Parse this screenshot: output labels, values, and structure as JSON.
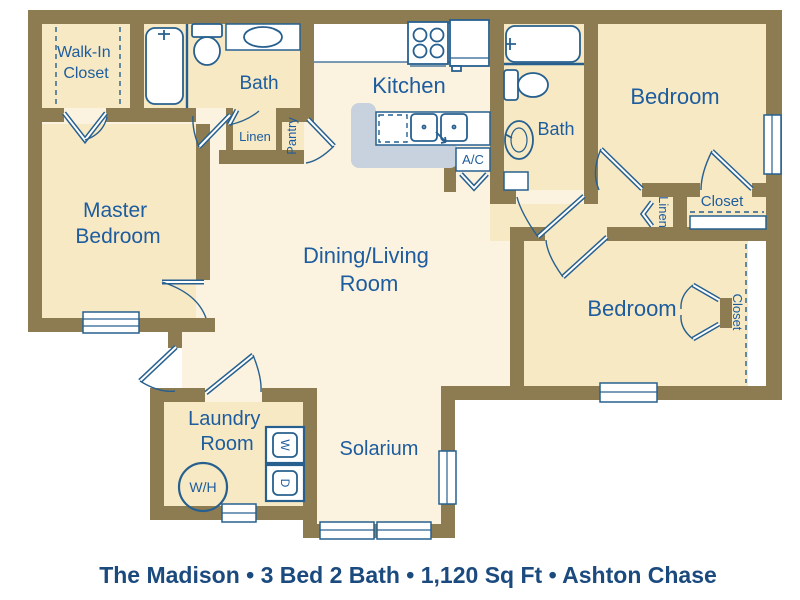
{
  "caption": "The Madison • 3 Bed 2 Bath • 1,120 Sq Ft • Ashton Chase",
  "rooms": {
    "walk_in_closet": {
      "line1": "Walk-In",
      "line2": "Closet"
    },
    "master_bedroom": {
      "line1": "Master",
      "line2": "Bedroom"
    },
    "dining_living": {
      "line1": "Dining/Living",
      "line2": "Room"
    },
    "laundry": {
      "line1": "Laundry",
      "line2": "Room"
    },
    "bath_master": "Bath",
    "bath_hall": "Bath",
    "kitchen": "Kitchen",
    "bedroom_top": "Bedroom",
    "bedroom_bottom": "Bedroom",
    "solarium": "Solarium",
    "pantry": "Pantry",
    "linen_bath": "Linen",
    "linen_hall": "Linen",
    "closet_bedroom_top": "Closet",
    "closet_bedroom_bottom": "Closet",
    "ac": "A/C",
    "water_heater": "W/H",
    "washer": "W",
    "dryer": "D"
  },
  "colors": {
    "wall": "#8d7c51",
    "beige": "#f7e9c4",
    "cream": "#fbf3df",
    "line": "#27608f",
    "label": "#1d5c9e",
    "caption_color": "#1b4a7e",
    "island": "#c8d1de"
  }
}
